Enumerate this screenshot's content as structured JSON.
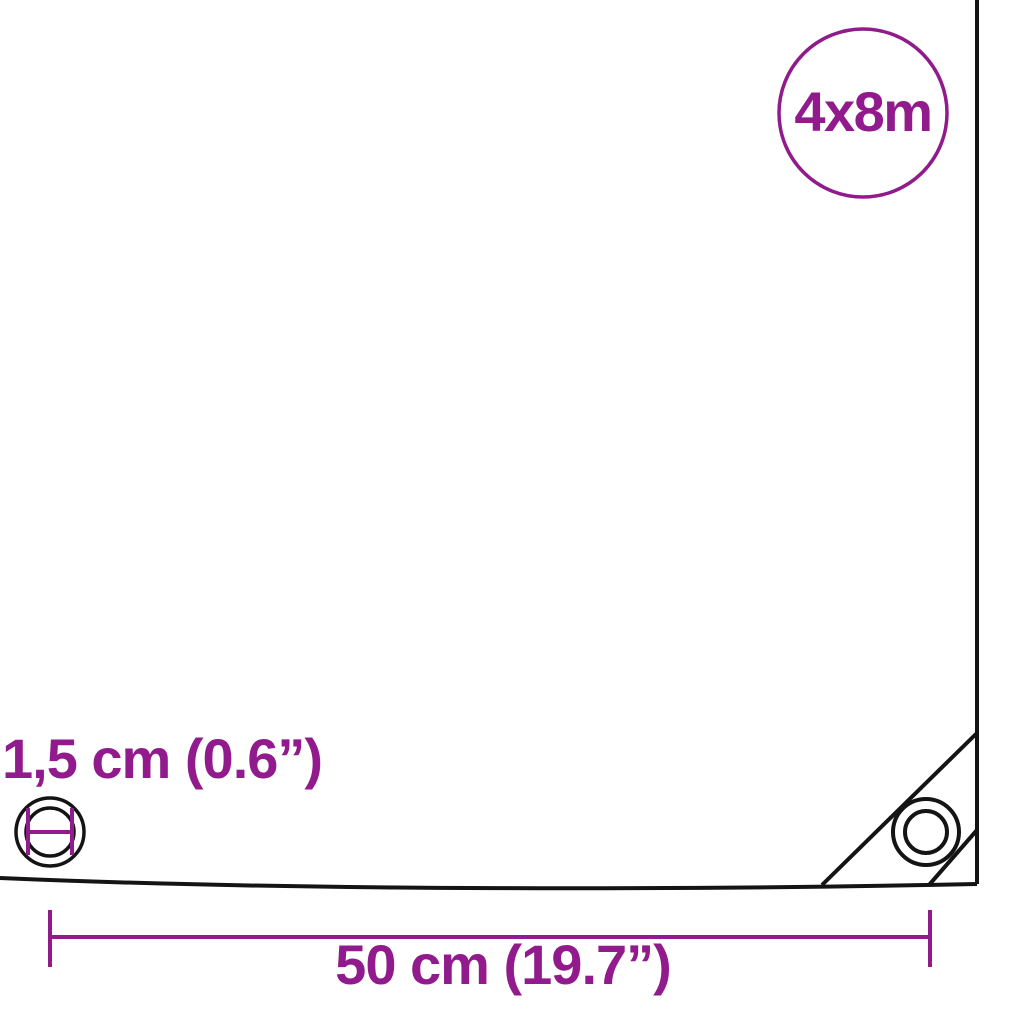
{
  "badge": {
    "size_label": "4x8m"
  },
  "dimensions": {
    "eyelet_diameter_label": "1,5 cm (0.6”)",
    "eyelet_spacing_label": "50 cm (19.7”)"
  },
  "icons": {
    "corner_eyelet": "eyelet-ring-icon",
    "eyelet_diameter": "eyelet-diameter-icon"
  },
  "colors": {
    "accent": "#911b8c",
    "line": "#141414",
    "background": "#ffffff"
  }
}
